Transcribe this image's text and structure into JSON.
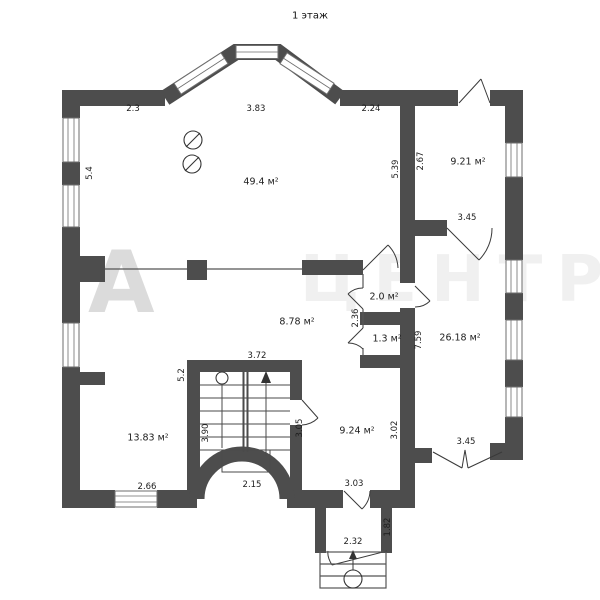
{
  "title": "1 этаж",
  "watermark": {
    "letter": "А",
    "text": "ЦЕНТР"
  },
  "colors": {
    "wall": "#4d4d4d",
    "line": "#3a3a3a",
    "dim_text": "#1d1d1d",
    "window_stroke": "#6e6e6e",
    "bg": "#ffffff"
  },
  "rooms": {
    "living": "49.4 м²",
    "top_right": "9.21 м²",
    "right": "26.18 м²",
    "hall": "8.78 м²",
    "closet": "2.0 м²",
    "wc": "1.3 м²",
    "bottom_left": "13.83 м²",
    "bottom": "9.24 м²"
  },
  "dims": {
    "top_left": "2.3",
    "top_bay": "3.83",
    "top_right": "2.24",
    "left_wall": "5.4",
    "living_right": "5.39",
    "room_tr_left": "2.67",
    "door_tr": "3.45",
    "closet_left": "2.36",
    "small_right": "7.59",
    "stair_wall": "5.2",
    "stair_top": "3.72",
    "stair_height": "3.90",
    "stair_bottom": "2.15",
    "stair_door": "3.05",
    "room_b_right": "3.02",
    "window_bl": "2.66",
    "door_bottom": "3.03",
    "opening_br": "3.45",
    "porch_side": "1.82",
    "porch_door": "2.32"
  }
}
